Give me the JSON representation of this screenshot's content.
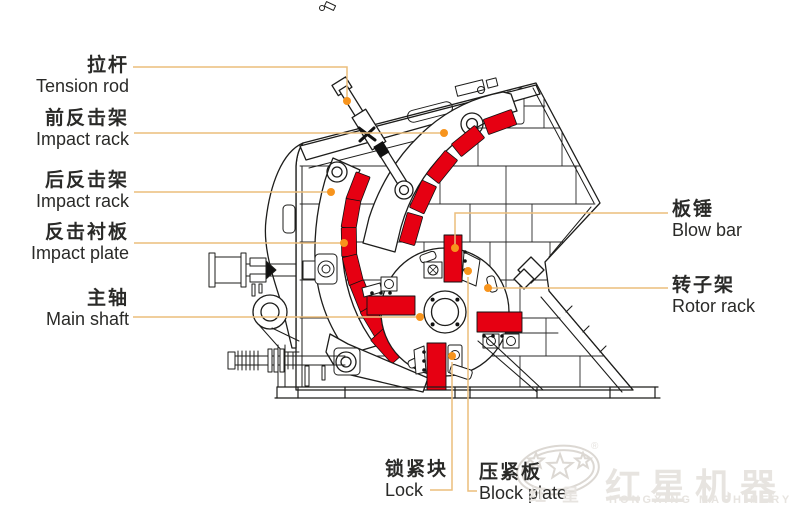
{
  "page": {
    "background": "#ffffff",
    "kind": "labeled technical diagram of an impact crusher"
  },
  "colors": {
    "part_red": "#e60012",
    "outline_black": "#1d1d1b",
    "leader_line": "#ecbe7c",
    "leader_dot": "#f7941d",
    "label_text": "#2a2a28",
    "watermark_gray": "#e7e4e0"
  },
  "diagram": {
    "labels": [
      {
        "id": "tension-rod",
        "zh": "拉杆",
        "en": "Tension rod",
        "side": "left"
      },
      {
        "id": "front-impact-rack",
        "zh": "前反击架",
        "en": "Impact rack",
        "side": "left"
      },
      {
        "id": "rear-impact-rack",
        "zh": "后反击架",
        "en": "Impact rack",
        "side": "left"
      },
      {
        "id": "impact-plate",
        "zh": "反击衬板",
        "en": "Impact plate",
        "side": "left"
      },
      {
        "id": "main-shaft",
        "zh": "主轴",
        "en": "Main shaft",
        "side": "left"
      },
      {
        "id": "blow-bar",
        "zh": "板锤",
        "en": "Blow bar",
        "side": "right"
      },
      {
        "id": "rotor-rack",
        "zh": "转子架",
        "en": "Rotor rack",
        "side": "right"
      },
      {
        "id": "lock",
        "zh": "锁紧块",
        "en": "Lock",
        "side": "bottom"
      },
      {
        "id": "block-plate",
        "zh": "压紧板",
        "en": "Block plate",
        "side": "bottom"
      }
    ]
  },
  "watermark": {
    "logo_zh": "红星机器",
    "logo_en": "HONGXING MACHINERY",
    "emblem_char_left": "红",
    "emblem_char_right": "星",
    "registered": "®"
  }
}
